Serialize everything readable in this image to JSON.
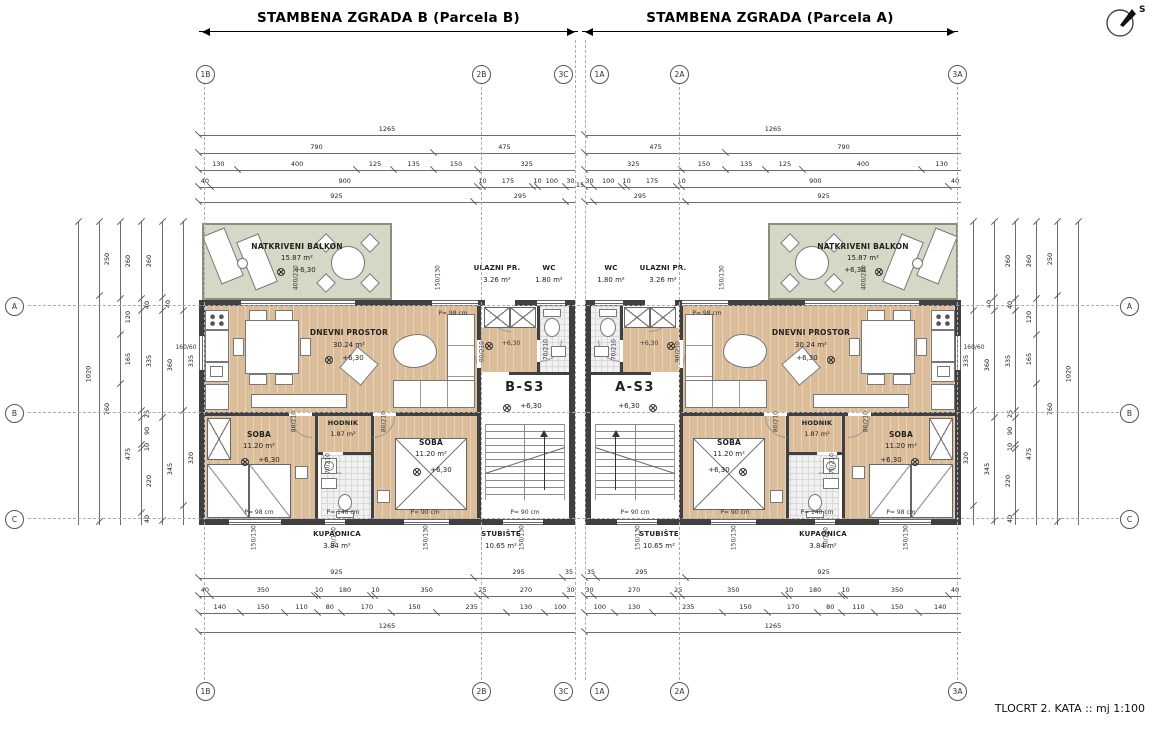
{
  "header": {
    "title_b": "STAMBENA ZGRADA B (Parcela B)",
    "title_a": "STAMBENA ZGRADA (Parcela A)"
  },
  "footer": {
    "caption": "TLOCRT 2. KATA :: mj 1:100"
  },
  "compass": {
    "label": "S"
  },
  "grid": {
    "top": [
      "1B",
      "2B",
      "3C",
      "1A",
      "2A",
      "3A"
    ],
    "bottom": [
      "1B",
      "2B",
      "3C",
      "1A",
      "2A",
      "3A"
    ],
    "left": [
      "A",
      "B",
      "C"
    ],
    "right": [
      "A",
      "B",
      "C"
    ]
  },
  "units": [
    {
      "code": "B-S3",
      "level": "+6,30"
    },
    {
      "code": "A-S3",
      "level": "+6,30"
    }
  ],
  "plan": {
    "balkon_name": "NATKRIVENI BALKON",
    "balkon_area": "15.87 m²",
    "dnevni_name": "DNEVNI PROSTOR",
    "dnevni_area": "30.24 m²",
    "ulazni_name": "ULAZNI PR.",
    "ulazni_area": "3.26 m²",
    "wc_name": "WC",
    "wc_area": "1.80 m²",
    "soba_name": "SOBA",
    "soba_area": "11.20 m²",
    "hodnik_name": "HODNIK",
    "hodnik_area": "1.87 m²",
    "kupaonica_name": "KUPAONICA",
    "kupaonica_area": "3.84 m²",
    "stubiste_name": "STUBIŠTE",
    "stubiste_area": "10.65 m²",
    "level": "+6,30",
    "p98": "P= 98 cm",
    "p90": "P= 90 cm",
    "p140": "P= 140 cm",
    "w400": "400/220",
    "w150": "150/130",
    "w160": "160/60",
    "w90": "90/130",
    "d80": "80/210",
    "d70": "70/210",
    "d90": "90/210"
  },
  "dims": {
    "mid15": "15",
    "t1": [
      {
        "l": "1265",
        "s": 1265
      }
    ],
    "t2": [
      {
        "l": "790",
        "s": 790
      },
      {
        "l": "475",
        "s": 475
      }
    ],
    "t3": [
      {
        "l": "130",
        "s": 130
      },
      {
        "l": "400",
        "s": 400
      },
      {
        "l": "125",
        "s": 125
      },
      {
        "l": "135",
        "s": 135
      },
      {
        "l": "150",
        "s": 150
      },
      {
        "l": "325",
        "s": 325
      }
    ],
    "t4": [
      {
        "l": "40",
        "s": 40
      },
      {
        "l": "900",
        "s": 900
      },
      {
        "l": "10",
        "s": 14
      },
      {
        "l": "175",
        "s": 171
      },
      {
        "l": "10",
        "s": 14
      },
      {
        "l": "100",
        "s": 96
      },
      {
        "l": "30",
        "s": 30
      }
    ],
    "t5": [
      {
        "l": "925",
        "s": 925
      },
      {
        "l": "295",
        "s": 310
      },
      {
        "l": "",
        "s": 30
      }
    ],
    "b1": [
      {
        "l": "925",
        "s": 925
      },
      {
        "l": "295",
        "s": 300
      },
      {
        "l": "35",
        "s": 40
      }
    ],
    "b2": [
      {
        "l": "40",
        "s": 40
      },
      {
        "l": "350",
        "s": 350
      },
      {
        "l": "10",
        "s": 12
      },
      {
        "l": "180",
        "s": 178
      },
      {
        "l": "10",
        "s": 12
      },
      {
        "l": "350",
        "s": 348
      },
      {
        "l": "25",
        "s": 25
      },
      {
        "l": "270",
        "s": 270
      },
      {
        "l": "30",
        "s": 30
      }
    ],
    "b3": [
      {
        "l": "140",
        "s": 140
      },
      {
        "l": "150",
        "s": 150
      },
      {
        "l": "110",
        "s": 110
      },
      {
        "l": "80",
        "s": 80
      },
      {
        "l": "170",
        "s": 170
      },
      {
        "l": "150",
        "s": 150
      },
      {
        "l": "235",
        "s": 235
      },
      {
        "l": "130",
        "s": 130
      },
      {
        "l": "100",
        "s": 100
      }
    ],
    "b4": [
      {
        "l": "1265",
        "s": 1265
      }
    ],
    "v1": [
      {
        "l": "1020",
        "s": 1020
      }
    ],
    "v2": [
      {
        "l": "250",
        "s": 250
      },
      {
        "l": "760",
        "s": 760
      },
      {
        "l": "",
        "s": 10
      }
    ],
    "v3": [
      {
        "l": "260",
        "s": 260
      },
      {
        "l": "120",
        "s": 120
      },
      {
        "l": "165",
        "s": 165
      },
      {
        "l": "475",
        "s": 475
      }
    ],
    "v4": [
      {
        "l": "260",
        "s": 260
      },
      {
        "l": "40",
        "s": 40
      },
      {
        "l": "335",
        "s": 335
      },
      {
        "l": "25",
        "s": 25
      },
      {
        "l": "90",
        "s": 90
      },
      {
        "l": "10",
        "s": 14
      },
      {
        "l": "220",
        "s": 216
      },
      {
        "l": "40",
        "s": 40
      }
    ],
    "v5": [
      {
        "l": "",
        "s": 255
      },
      {
        "l": "40",
        "s": 45
      },
      {
        "l": "360",
        "s": 360
      },
      {
        "l": "345",
        "s": 345
      },
      {
        "l": "",
        "s": 15
      }
    ],
    "v6": [
      {
        "l": "",
        "s": 300
      },
      {
        "l": "335",
        "s": 335
      },
      {
        "l": "320",
        "s": 320
      },
      {
        "l": "",
        "s": 65
      }
    ]
  }
}
